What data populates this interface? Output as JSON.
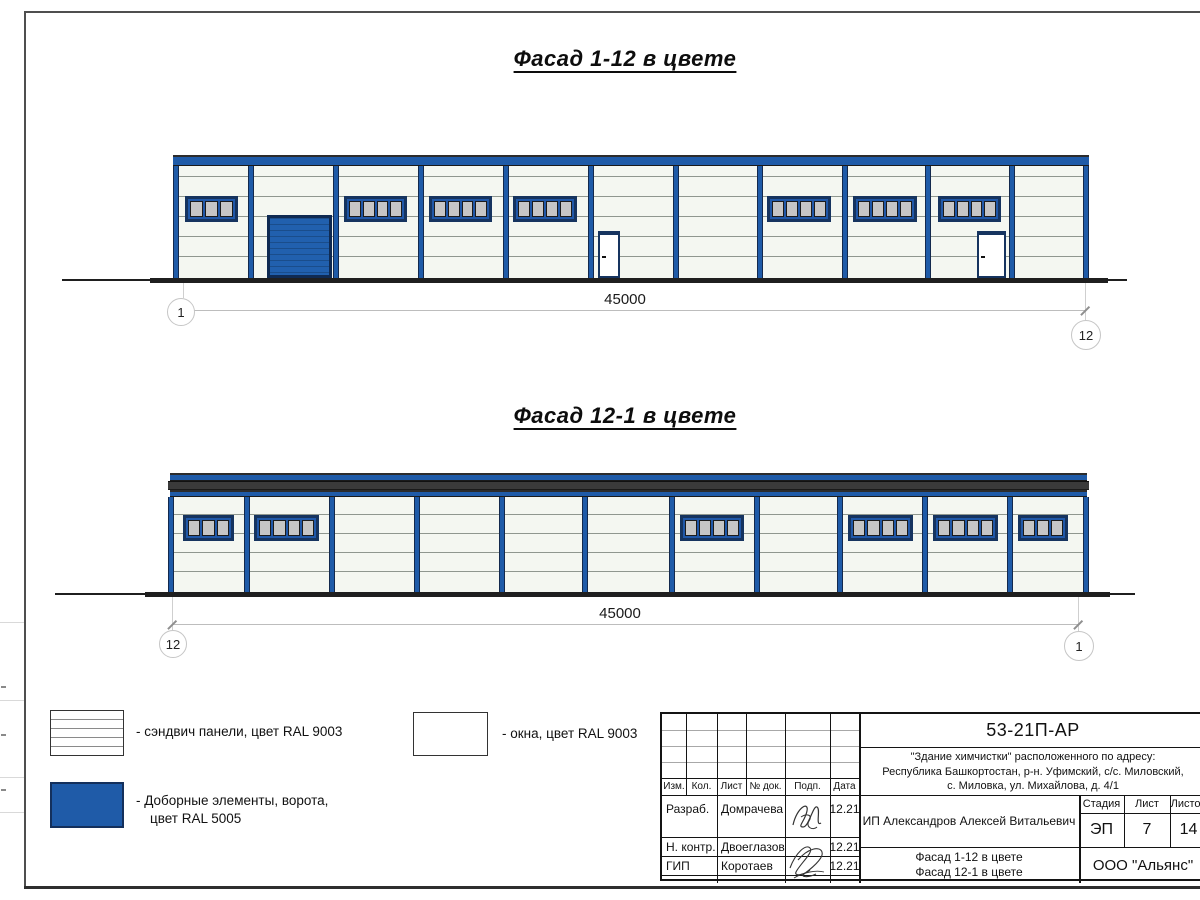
{
  "colors": {
    "accent_blue": "#1f5ba8",
    "navy": "#16345f",
    "gate_blue": "#2160ae",
    "panel_bg": "#f4f7f1",
    "panel_line": "#8f978f",
    "pane_gray": "#c6c6c6",
    "ground": "#1f1f1f",
    "dark_band": "#3a3a3a",
    "dim_gray": "#bdbdbd"
  },
  "drawing": {
    "facades": [
      {
        "name": "facade-1-12",
        "title": "Фасад 1-12 в цвете",
        "title_box": {
          "x": 440,
          "y": 46,
          "w": 370
        },
        "band_segments": [
          {
            "x": 173,
            "y": 155,
            "w": 916,
            "h": 11,
            "type": "blue"
          }
        ],
        "body": {
          "x": 173,
          "y": 166,
          "w": 916,
          "h": 112,
          "line_offset": 10,
          "line_gap": 20
        },
        "columns_x": [
          173,
          248,
          333,
          418,
          503,
          588,
          673,
          757,
          842,
          925,
          1009,
          1083
        ],
        "column_w": 6,
        "window_h": 26,
        "windows": [
          {
            "x": 185,
            "y": 196,
            "w": 53,
            "panes": 3
          },
          {
            "x": 344,
            "y": 196,
            "w": 63,
            "panes": 4
          },
          {
            "x": 429,
            "y": 196,
            "w": 63,
            "panes": 4
          },
          {
            "x": 513,
            "y": 196,
            "w": 64,
            "panes": 4
          },
          {
            "x": 767,
            "y": 196,
            "w": 64,
            "panes": 4
          },
          {
            "x": 853,
            "y": 196,
            "w": 64,
            "panes": 4
          },
          {
            "x": 938,
            "y": 196,
            "w": 63,
            "panes": 4
          }
        ],
        "gate": {
          "x": 267,
          "y": 215,
          "w": 65,
          "h": 63
        },
        "doors": [
          {
            "x": 598,
            "y": 231,
            "w": 22,
            "h": 47
          },
          {
            "x": 977,
            "y": 231,
            "w": 29,
            "h": 47
          }
        ],
        "ground": {
          "y": 278,
          "x1": 62,
          "x2": 1127,
          "main_x1": 150,
          "main_x2": 1108,
          "thick": 5,
          "thin": 2
        },
        "dim": {
          "label": "45000",
          "line_y": 310,
          "x1": 183,
          "x2": 1085,
          "label_cx": 625,
          "ext_top": 283,
          "bubbles": [
            {
              "label": "1",
              "cx": 180,
              "cy": 311,
              "r": 13
            },
            {
              "label": "12",
              "cx": 1085,
              "cy": 334,
              "r": 14
            }
          ]
        }
      },
      {
        "name": "facade-12-1",
        "title": "Фасад 12-1 в цвете",
        "title_box": {
          "x": 440,
          "y": 403,
          "w": 370
        },
        "band_segments": [
          {
            "x": 170,
            "y": 473,
            "w": 917,
            "h": 8,
            "type": "blue"
          },
          {
            "x": 168,
            "y": 481,
            "w": 921,
            "h": 9,
            "type": "dark"
          },
          {
            "x": 170,
            "y": 490,
            "w": 917,
            "h": 7,
            "type": "blue"
          }
        ],
        "body": {
          "x": 168,
          "y": 497,
          "w": 921,
          "h": 95,
          "line_offset": 17,
          "line_gap": 19
        },
        "columns_x": [
          168,
          244,
          329,
          414,
          499,
          582,
          669,
          754,
          837,
          922,
          1007,
          1083
        ],
        "column_w": 6,
        "window_h": 26,
        "windows": [
          {
            "x": 183,
            "y": 515,
            "w": 51,
            "panes": 3
          },
          {
            "x": 254,
            "y": 515,
            "w": 65,
            "panes": 4
          },
          {
            "x": 680,
            "y": 515,
            "w": 64,
            "panes": 4
          },
          {
            "x": 848,
            "y": 515,
            "w": 65,
            "panes": 4
          },
          {
            "x": 933,
            "y": 515,
            "w": 65,
            "panes": 4
          },
          {
            "x": 1018,
            "y": 515,
            "w": 50,
            "panes": 3
          }
        ],
        "gate": null,
        "doors": [],
        "ground": {
          "y": 592,
          "x1": 55,
          "x2": 1135,
          "main_x1": 145,
          "main_x2": 1110,
          "thick": 5,
          "thin": 2
        },
        "dim": {
          "label": "45000",
          "line_y": 624,
          "x1": 172,
          "x2": 1078,
          "label_cx": 620,
          "ext_top": 597,
          "bubbles": [
            {
              "label": "12",
              "cx": 172,
              "cy": 643,
              "r": 13
            },
            {
              "label": "1",
              "cx": 1078,
              "cy": 645,
              "r": 14
            }
          ]
        }
      }
    ]
  },
  "legend": {
    "sandwich_label": "- сэндвич панели, цвет RAL 9003",
    "windows_label": "- окна, цвет RAL 9003",
    "accent_label_line1": "- Доборные элементы, ворота,",
    "accent_label_line2": "цвет RAL 5005"
  },
  "title_block": {
    "doc_code": "53-21П-АР",
    "address_line1": "\"Здание химчистки\" расположенного по адресу:",
    "address_line2": "Республика Башкортостан, р-н. Уфимский, с/с. Миловский,",
    "address_line3": "с. Миловка, ул. Михайлова, д. 4/1",
    "client": "ИП Александров Алексей Витальевич",
    "columns": {
      "izm": "Изм.",
      "kol": "Кол.",
      "list": "Лист",
      "doc": "№ док.",
      "podp": "Подп.",
      "data": "Дата"
    },
    "stage_header": {
      "stage": "Стадия",
      "sheet": "Лист",
      "sheets": "Листов"
    },
    "stage_values": {
      "stage": "ЭП",
      "sheet": "7",
      "sheets": "14"
    },
    "roles": [
      {
        "role": "Разраб.",
        "name": "Домрачева",
        "date": "12.21"
      },
      {
        "role": "Н. контр.",
        "name": "Двоеглазов",
        "date": "12.21"
      },
      {
        "role": "ГИП",
        "name": "Коротаев",
        "date": "12.21"
      }
    ],
    "sheet_title_line1": "Фасад 1-12 в цвете",
    "sheet_title_line2": "Фасад 12-1 в цвете",
    "company": "ООО \"Альянс\""
  }
}
